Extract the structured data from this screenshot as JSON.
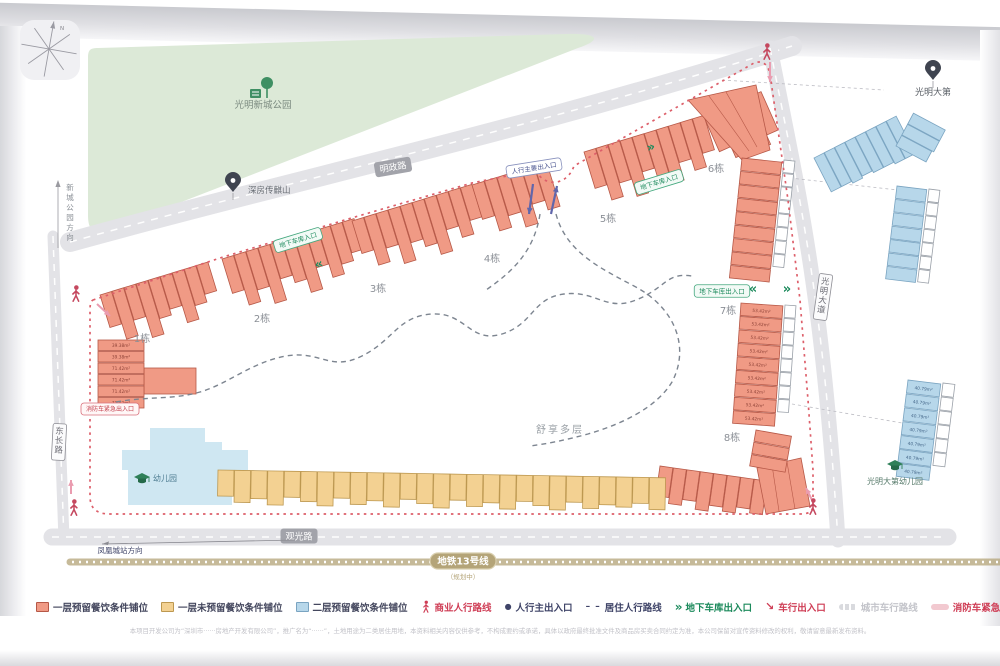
{
  "colors": {
    "shop_l1_reserved_fill": "#f09a85",
    "shop_l1_reserved_stroke": "#b65847",
    "shop_l1_unreserved_fill": "#f3d192",
    "shop_l1_unreserved_stroke": "#bd9850",
    "shop_l2_reserved_fill": "#b7d7ea",
    "shop_l2_reserved_stroke": "#7aa4c1",
    "park_green": "#dce9d7",
    "park_icon_green": "#3f8f63",
    "road_grey": "#e3e3e7",
    "road_label_grey": "#a2a3aa",
    "fire_route_red": "#dd5f6a",
    "fire_swatch_pink": "#f2c9d0",
    "garage_green": "#1c8a5c",
    "pedestrian_navy": "#3f4468",
    "commercial_red": "#cf3d55",
    "metro_tan": "#b4a478",
    "residential_route_grey": "#7d8590",
    "person_crimson": "#c5485f",
    "kindergarten_blue": "#cfe7f2",
    "pink_arrow": "#ea9cb0",
    "entry_arrow_blue": "#6066ab"
  },
  "map": {
    "compass_north": "N",
    "park": {
      "label": "光明新城公园"
    },
    "pins": {
      "left": "深房传麒山",
      "right": "光明大第"
    },
    "schools": {
      "site_kindergarten": "幼儿园",
      "right_kindergarten": "光明大第幼儿园"
    },
    "roads": {
      "top": "明政路",
      "bottom": "观光路",
      "left": "东长路",
      "right": "光明大道"
    },
    "directions": {
      "park": "新城公园方向",
      "station": "凤凰城站方向"
    },
    "metro": {
      "label": "地铁13号线",
      "note": "（规划中）"
    },
    "area_note": "舒享多层",
    "badges": [
      {
        "label": "地下车库入口",
        "style": "green"
      },
      {
        "label": "地下车库入口",
        "style": "green"
      },
      {
        "label": "地下车库出入口",
        "style": "green"
      },
      {
        "label": "人行主要出入口",
        "style": "navy"
      },
      {
        "label": "消防车紧急出入口",
        "style": "red"
      }
    ],
    "buildings": {
      "labels": [
        "1栋",
        "2栋",
        "3栋",
        "4栋",
        "5栋",
        "6栋",
        "7栋",
        "8栋"
      ],
      "unit_areas": {
        "building1_rows": [
          "39.38m²",
          "39.38m²",
          "71.42m²",
          "71.42m²",
          "71.42m²",
          "71.42m²"
        ],
        "building7_rows": "53.42m²",
        "east_blue_rows": "40.79m²"
      }
    }
  },
  "legend": {
    "items": [
      {
        "icon": "swatch-orange",
        "label": "一层预留餐饮条件铺位"
      },
      {
        "icon": "swatch-yellow",
        "label": "一层未预留餐饮条件铺位"
      },
      {
        "icon": "swatch-blue",
        "label": "二层预留餐饮条件铺位"
      },
      {
        "icon": "person",
        "label": "商业人行路线"
      },
      {
        "icon": "dot",
        "label": "人行主出入口"
      },
      {
        "icon": "dashes",
        "label": "居住人行路线"
      },
      {
        "icon": "chevrons",
        "label": "地下车库出入口"
      },
      {
        "icon": "arrow",
        "label": "车行出入口"
      },
      {
        "icon": "road",
        "label": "城市车行路线"
      },
      {
        "icon": "fire",
        "label": "消防车紧急出入口"
      }
    ]
  },
  "disclaimer": "本项目开发公司为“深圳市······房地产开发有限公司”，推广名为“······”，土地用途为二类居住用地，本资料相关内容仅供参考，不构成要约或承诺，具体以政府最终批准文件及商品房买卖合同约定为准，本公司保留对宣传资料修改的权利，敬请留意最新发布资料。"
}
